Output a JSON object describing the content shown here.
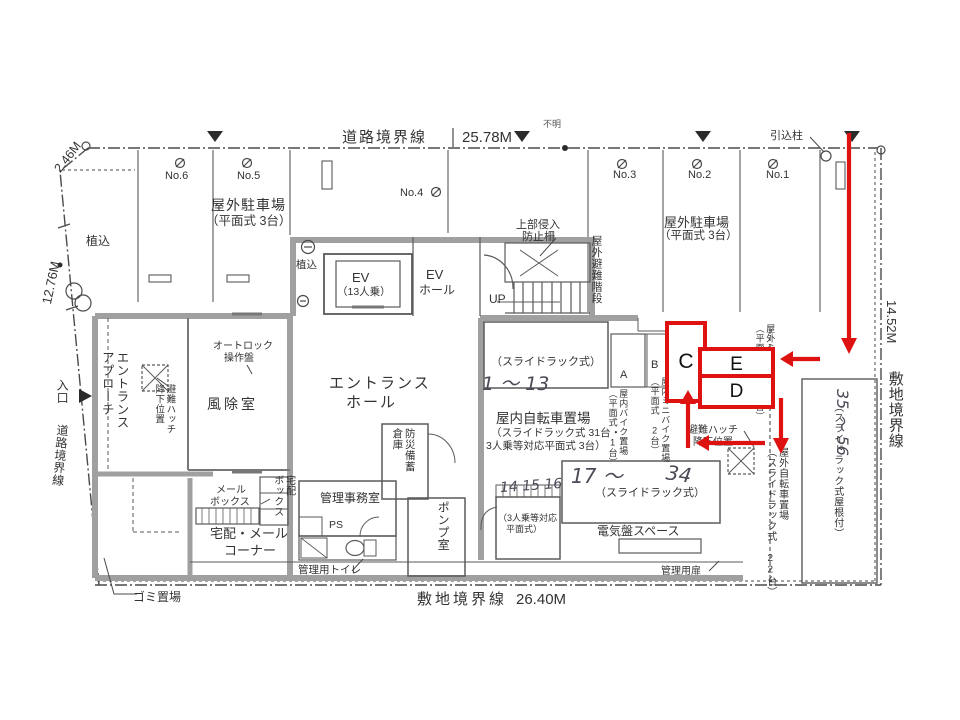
{
  "boundaries": {
    "top": {
      "label": "道路境界線",
      "dim": "25.78M"
    },
    "right": {
      "label": "敷地境界線",
      "dim": "14.52M"
    },
    "bottom": {
      "label": "敷地境界線",
      "dim": "26.40M"
    },
    "left": {
      "label": "道路境界線",
      "dim_upper": "2.46M",
      "dim_lower": "12.76M"
    },
    "entrance_label": "入口",
    "service_pole": "引込柱",
    "unknown_pole": "不明"
  },
  "outdoor_parking": {
    "stalls": [
      "No.6",
      "No.5",
      "No.4",
      "No.3",
      "No.2",
      "No.1"
    ],
    "label": "屋外駐車場",
    "sub": "（平面式 3台）",
    "fence_line1": "上部侵入",
    "fence_line2": "防止柵"
  },
  "building": {
    "entrance_approach": "エントランス\nアプローチ",
    "evac_hatch": "避難ハッチ\n降下位置",
    "autolock1": "オートロック",
    "autolock2": "操作盤",
    "windbreak": "風除室",
    "hall1": "エントランス",
    "hall2": "ホール",
    "ev": "EV",
    "ev_capacity": "（13人乗）",
    "ev_hall1": "EV",
    "ev_hall2": "ホール",
    "up": "UP",
    "outdoor_escape_stair": "屋外避難階段",
    "planting": "植込",
    "disaster": "防災備蓄\n倉庫",
    "pump": "ポンプ室",
    "mail1": "メール",
    "mail2": "ボックス",
    "delivery": "宅配\nボックス",
    "corner1": "宅配・メール",
    "corner2": "コーナー",
    "office": "管理事務室",
    "ps": "PS",
    "toilet": "管理用トイレ",
    "garbage": "ゴミ置場"
  },
  "bicycle": {
    "rack_paren": "（スライドラック式）",
    "indoor_title": "屋内自転車置場",
    "indoor_sub1": "（スライドラック式 31台・",
    "indoor_sub2": "3人乗等対応平面式 3台）",
    "stall_a": "A",
    "stall_b": "B",
    "indoor_bike": "屋内バイク置場\n（平面式 1台）",
    "indoor_minibike": "屋内ミニバイク置場\n（平面式 2台）",
    "outdoor_minibike": "屋外ミニバイク置場\n（平面式 軒下2台）",
    "hatch1": "避難ハッチ",
    "hatch2": "降下位置",
    "three1": "（3人乗等対応",
    "three2": "平面式）",
    "elec": "電気盤スペース",
    "admin_door": "管理用扉",
    "outdoor": "屋外自転車置場\n（スライドラック式 22台）",
    "roofed": "（スライドラック式屋根付）"
  },
  "handwritten": {
    "h1": "1 〜 13",
    "h2": "14 15 16",
    "h3": "17 〜",
    "h3b": "34",
    "h4": "35 〜 56"
  },
  "annotations": {
    "color": "#df1212",
    "box_c": "C",
    "box_e": "E",
    "box_d": "D"
  }
}
